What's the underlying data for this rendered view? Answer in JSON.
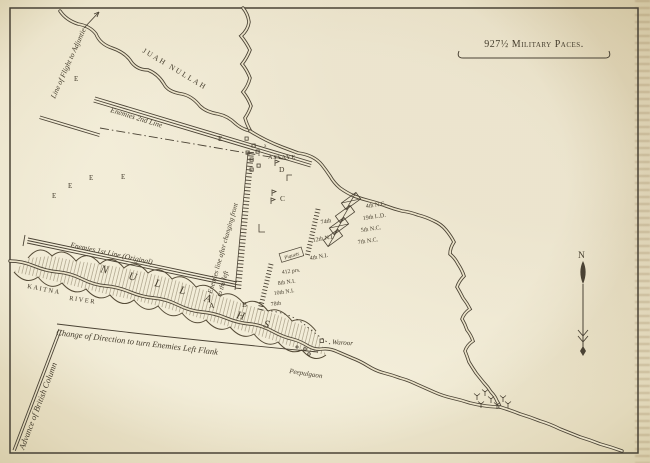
{
  "colors": {
    "paper": "#eae2c8",
    "ink": "#4a4234"
  },
  "scale_bar": {
    "label": "927½ Military Paces."
  },
  "compass": {
    "label": "N"
  },
  "rivers": {
    "juah": "JUAH NULLAH",
    "kaitna_line1": "KAITNA",
    "kaitna_line2": "RIVER",
    "nullah": {
      "n1": "N",
      "u": "U",
      "l1": "L",
      "l2": "L",
      "a": "A",
      "h": "H",
      "s": "S"
    }
  },
  "routes": {
    "flight": "Line of Flight to Adjuntie",
    "advance": "Advance of British Column",
    "change_direction": "Change of Direction to turn Enemies Left Flank"
  },
  "enemy": {
    "second_line": "Enemies 2nd Line",
    "first_line": "Enemies 1st Line (Original)",
    "changed_front_line1": "Enemies line after changing front",
    "changed_front_line2": "to the left"
  },
  "british": {
    "piquets": "Piquets",
    "first_line": [
      "74th",
      "12th N.I.",
      "4th N.I."
    ],
    "second_line": [
      "412 prs.",
      "8th N.I.",
      "10th N.I.",
      "78th"
    ],
    "cavalry": [
      "4th N.C.",
      "19th L.D.",
      "5th N.C.",
      "7th N.C."
    ]
  },
  "villages": {
    "assaye": "ASSAYE",
    "waroor": "Waroor",
    "peepulgaon": "Peepulgaon"
  },
  "reference_letters": {
    "a": "A",
    "b": "B",
    "c": "C",
    "d": "D",
    "e": "E",
    "x": "x"
  }
}
